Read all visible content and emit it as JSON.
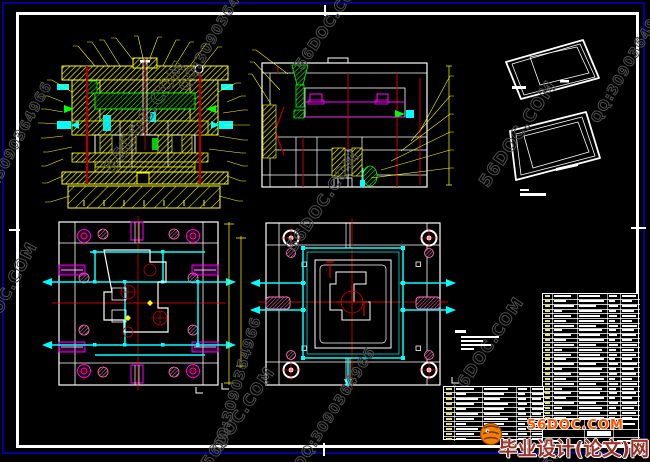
{
  "palette": {
    "background": "#000000",
    "frame_blue": "#000099",
    "frame_white": "#ffffff",
    "cad_yellow": "#ffff00",
    "cad_green": "#00ff00",
    "cad_cyan": "#00ffff",
    "cad_magenta": "#ff00ff",
    "cad_pink": "#ff77bb",
    "cad_red": "#ff0000",
    "cad_darkred": "#aa0000",
    "watermark_gray": "#4f4f4f",
    "logo_accent": "#ff5500",
    "logo_text": "#993328"
  },
  "watermarks": {
    "default_rotation": -56,
    "items": [
      {
        "text": "56DOC.COM",
        "x": -14,
        "y": 348,
        "size": 16,
        "rot": -62
      },
      {
        "text": "QQ:3090364966",
        "x": -10,
        "y": 208,
        "size": 14,
        "rot": -62
      },
      {
        "text": "QQ:3090364966",
        "x": 190,
        "y": 92,
        "size": 14,
        "rot": -60
      },
      {
        "text": "56DOC.COM",
        "x": 118,
        "y": 174,
        "size": 18,
        "rot": -56
      },
      {
        "text": "56DOC.COM",
        "x": 213,
        "y": 468,
        "size": 16,
        "rot": -56
      },
      {
        "text": "QQ:3090364966",
        "x": 226,
        "y": 452,
        "size": 14,
        "rot": -74
      },
      {
        "text": "56DOC.COM",
        "x": 298,
        "y": 252,
        "size": 16,
        "rot": -56
      },
      {
        "text": "56DOC.COM",
        "x": 306,
        "y": 70,
        "size": 15,
        "rot": -56
      },
      {
        "text": "QQ:3090364966",
        "x": 305,
        "y": 470,
        "size": 14,
        "rot": -58
      },
      {
        "text": "56DOC.COM",
        "x": 492,
        "y": 188,
        "size": 17,
        "rot": -56
      },
      {
        "text": "56DOC.COM",
        "x": 462,
        "y": 398,
        "size": 16,
        "rot": -56
      },
      {
        "text": "56DOC.COM",
        "x": 553,
        "y": 470,
        "size": 14,
        "rot": -56
      },
      {
        "text": "QQ:3090364966",
        "x": 602,
        "y": 124,
        "size": 14,
        "rot": -60
      }
    ]
  },
  "logo": {
    "site": "56DOC.COM",
    "name": "毕业设计(论文)网"
  },
  "notes_block": {
    "x": 455,
    "y": 330,
    "heading_width": 11,
    "line_indent": 6,
    "line_widths": [
      38,
      22,
      30,
      13
    ]
  },
  "iso_caption": {
    "x": 520,
    "y": 189,
    "bar_widths": [
      9,
      26
    ]
  },
  "bom_table_right": {
    "x": 542,
    "y": 293,
    "w": 97,
    "h": 126,
    "rows": 26,
    "cols": [
      9,
      34,
      64,
      77
    ],
    "bar_patterns": [
      [
        17,
        21,
        8,
        14
      ],
      [
        12,
        25,
        6,
        10
      ],
      [
        20,
        17,
        9,
        15
      ],
      [
        8,
        23,
        7,
        12
      ]
    ]
  },
  "title_table_left": {
    "x": 443,
    "y": 386,
    "w": 101,
    "h": 54,
    "rows": 11,
    "cols": [
      10,
      38,
      72,
      86
    ],
    "bar_patterns": [
      [
        18,
        24,
        9,
        11
      ],
      [
        10,
        20,
        7,
        13
      ],
      [
        22,
        16,
        8,
        9
      ]
    ]
  },
  "title_block": {
    "x": 542,
    "y": 419,
    "w": 97,
    "h": 26,
    "hlines": [
      9,
      17
    ],
    "vlines": [
      41,
      70
    ],
    "white_cell": {
      "x": 44,
      "y": 11,
      "w": 24,
      "h": 5
    },
    "bars": [
      [
        3,
        3,
        20
      ],
      [
        3,
        20,
        16
      ],
      [
        74,
        3,
        18
      ],
      [
        74,
        20,
        14
      ]
    ]
  }
}
